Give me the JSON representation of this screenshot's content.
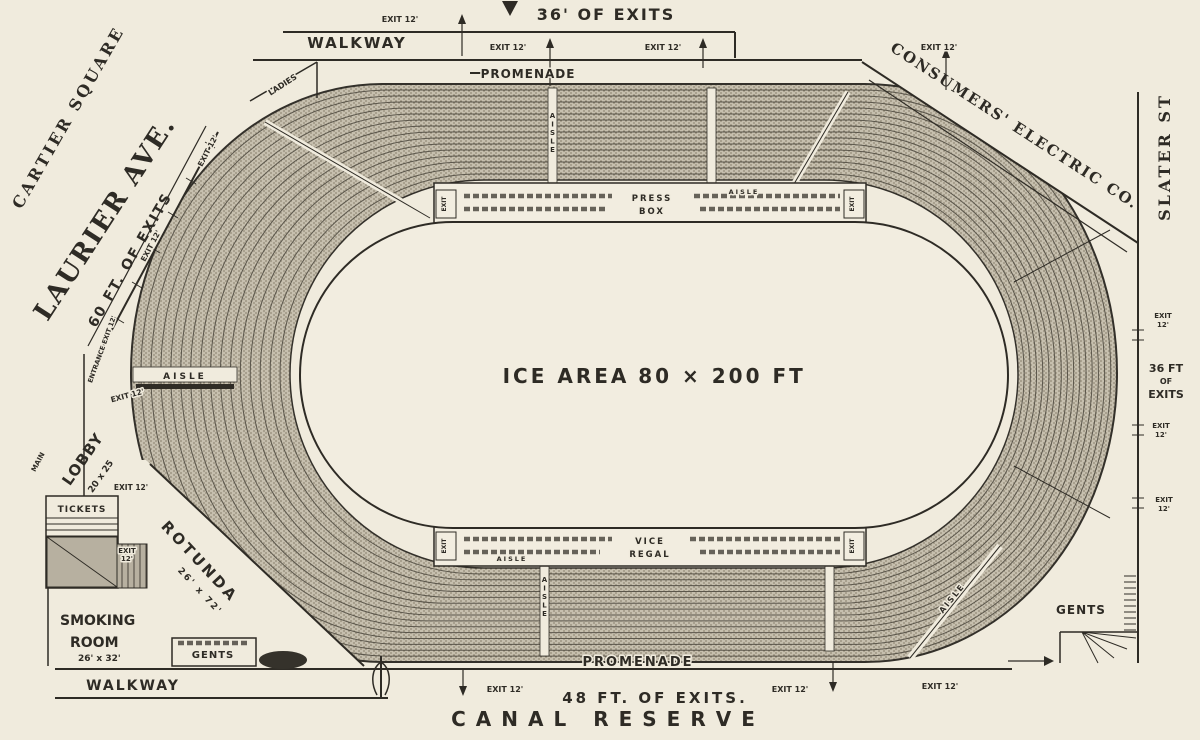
{
  "colors": {
    "background": "#f0ebdd",
    "ink": "#2e2b25",
    "seating_base": "#c6bfae",
    "seating_hatch": "#89826f",
    "shaded_block": "#b7b0a0"
  },
  "streets": {
    "cartier_square": "CARTIER SQUARE",
    "laurier_ave": "LAURIER AVE.",
    "slater_st": "SLATER ST",
    "consumers_electric": "CONSUMERS' ELECTRIC CO.",
    "canal_reserve": "CANAL RESERVE"
  },
  "exits": {
    "top": "36' OF EXITS",
    "left": "60 FT. OF EXITS",
    "right_l1": "36 FT",
    "right_l2": "OF",
    "right_l3": "EXITS",
    "bottom": "48 FT. OF EXITS.",
    "exit_12": "EXIT 12'",
    "exit": "EXIT",
    "twelve": "12'",
    "entrance": "ENTRANCE EXIT 12'"
  },
  "walkways": {
    "walkway": "WALKWAY",
    "promenade": "PROMENADE"
  },
  "rooms": {
    "lobby": "LOBBY",
    "lobby_size": "20 x 25",
    "rotunda": "ROTUNDA",
    "rotunda_size": "26' x 72'",
    "smoking_line1": "SMOKING",
    "smoking_line2": "ROOM",
    "smoking_size": "26' x 32'",
    "tickets": "TICKETS",
    "gents": "GENTS",
    "ladies": "LADIES",
    "main": "MAIN"
  },
  "boxes": {
    "press_line1": "PRESS",
    "press_line2": "BOX",
    "vice_line1": "VICE",
    "vice_line2": "REGAL",
    "aisle": "AISLE"
  },
  "ice": {
    "label_1": "ICE AREA",
    "label_2": "80 × 200 FT"
  }
}
